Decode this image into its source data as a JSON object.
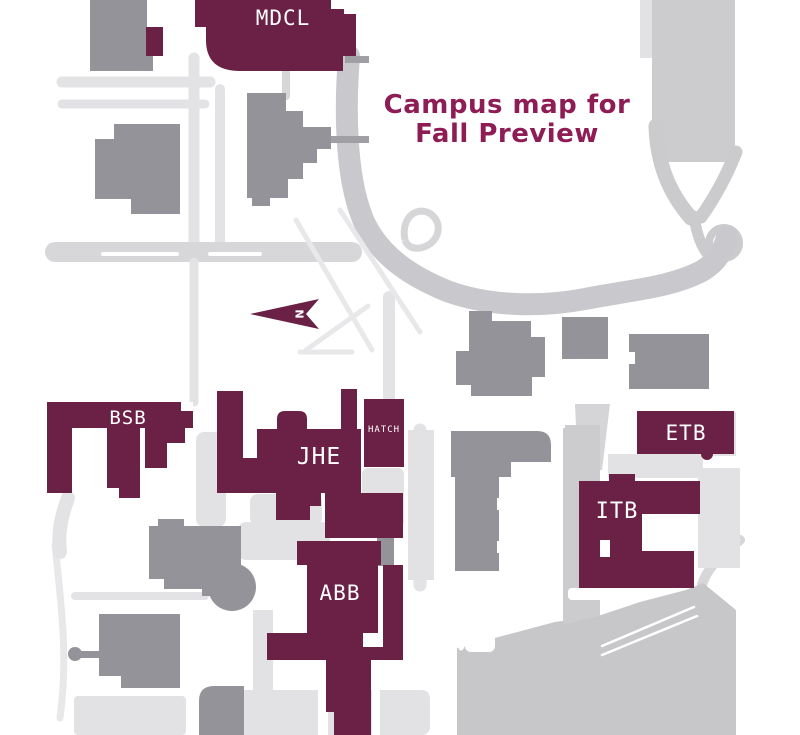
{
  "title": {
    "line1": "Campus map for",
    "line2": "Fall Preview"
  },
  "map": {
    "highlighted_buildings": [
      {
        "id": "mdcl",
        "label": "MDCL"
      },
      {
        "id": "bsb",
        "label": "BSB"
      },
      {
        "id": "jhe",
        "label": "JHE"
      },
      {
        "id": "hatch",
        "label": "HATCH"
      },
      {
        "id": "etb",
        "label": "ETB"
      },
      {
        "id": "itb",
        "label": "ITB"
      },
      {
        "id": "abb",
        "label": "ABB"
      }
    ],
    "north_arrow": {
      "label": "N"
    }
  },
  "colors": {
    "highlight": "#6b2146",
    "title": "#8e1c55",
    "building_gray": "#939399",
    "road_main": "#c9c9cd",
    "lot": "#c7c7ca",
    "label_text": "#ffffff",
    "background": "#ffffff"
  }
}
